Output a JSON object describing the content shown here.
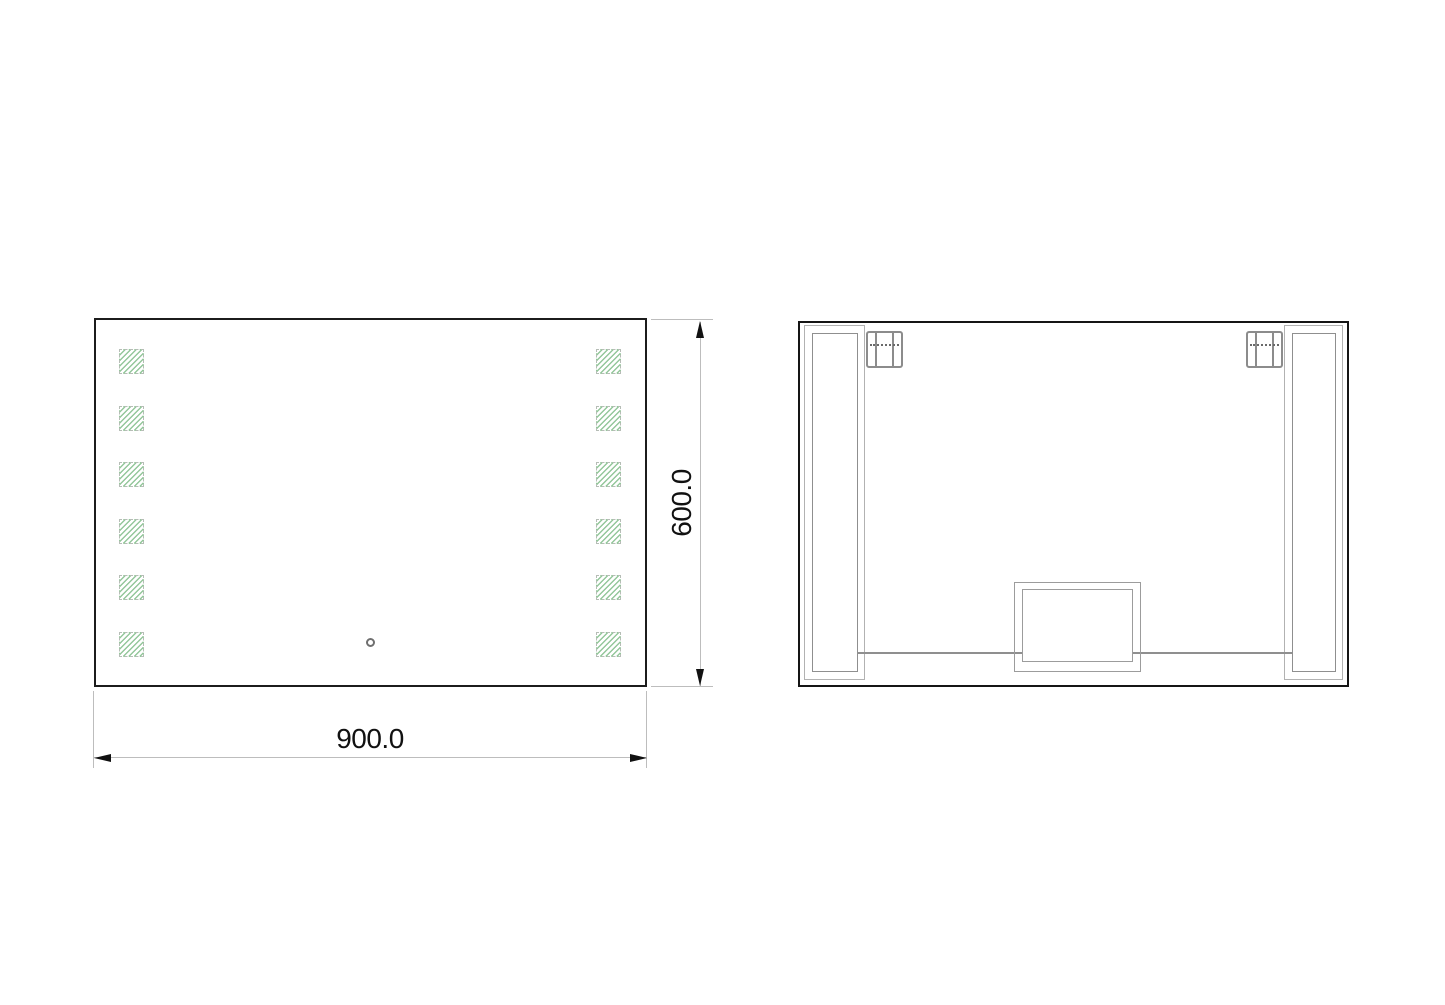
{
  "front_view": {
    "width_dimension_label": "900.0",
    "height_dimension_label": "600.0",
    "led_pad_columns": 2,
    "led_pads_per_column": 6,
    "led_pad_hatch_color": "#94c79b",
    "outline_color": "#1c1c1c",
    "touch_sensor_shape": "circle"
  },
  "back_view": {
    "outline_color": "#151515",
    "rail_count": 2,
    "clip_count": 2,
    "wire_color": "#8f8f8f",
    "junction_box_color": "#9c9c9c"
  },
  "dimension_style": {
    "line_color": "#bdbdbd",
    "arrow_color": "#111111",
    "text_color": "#111111"
  }
}
